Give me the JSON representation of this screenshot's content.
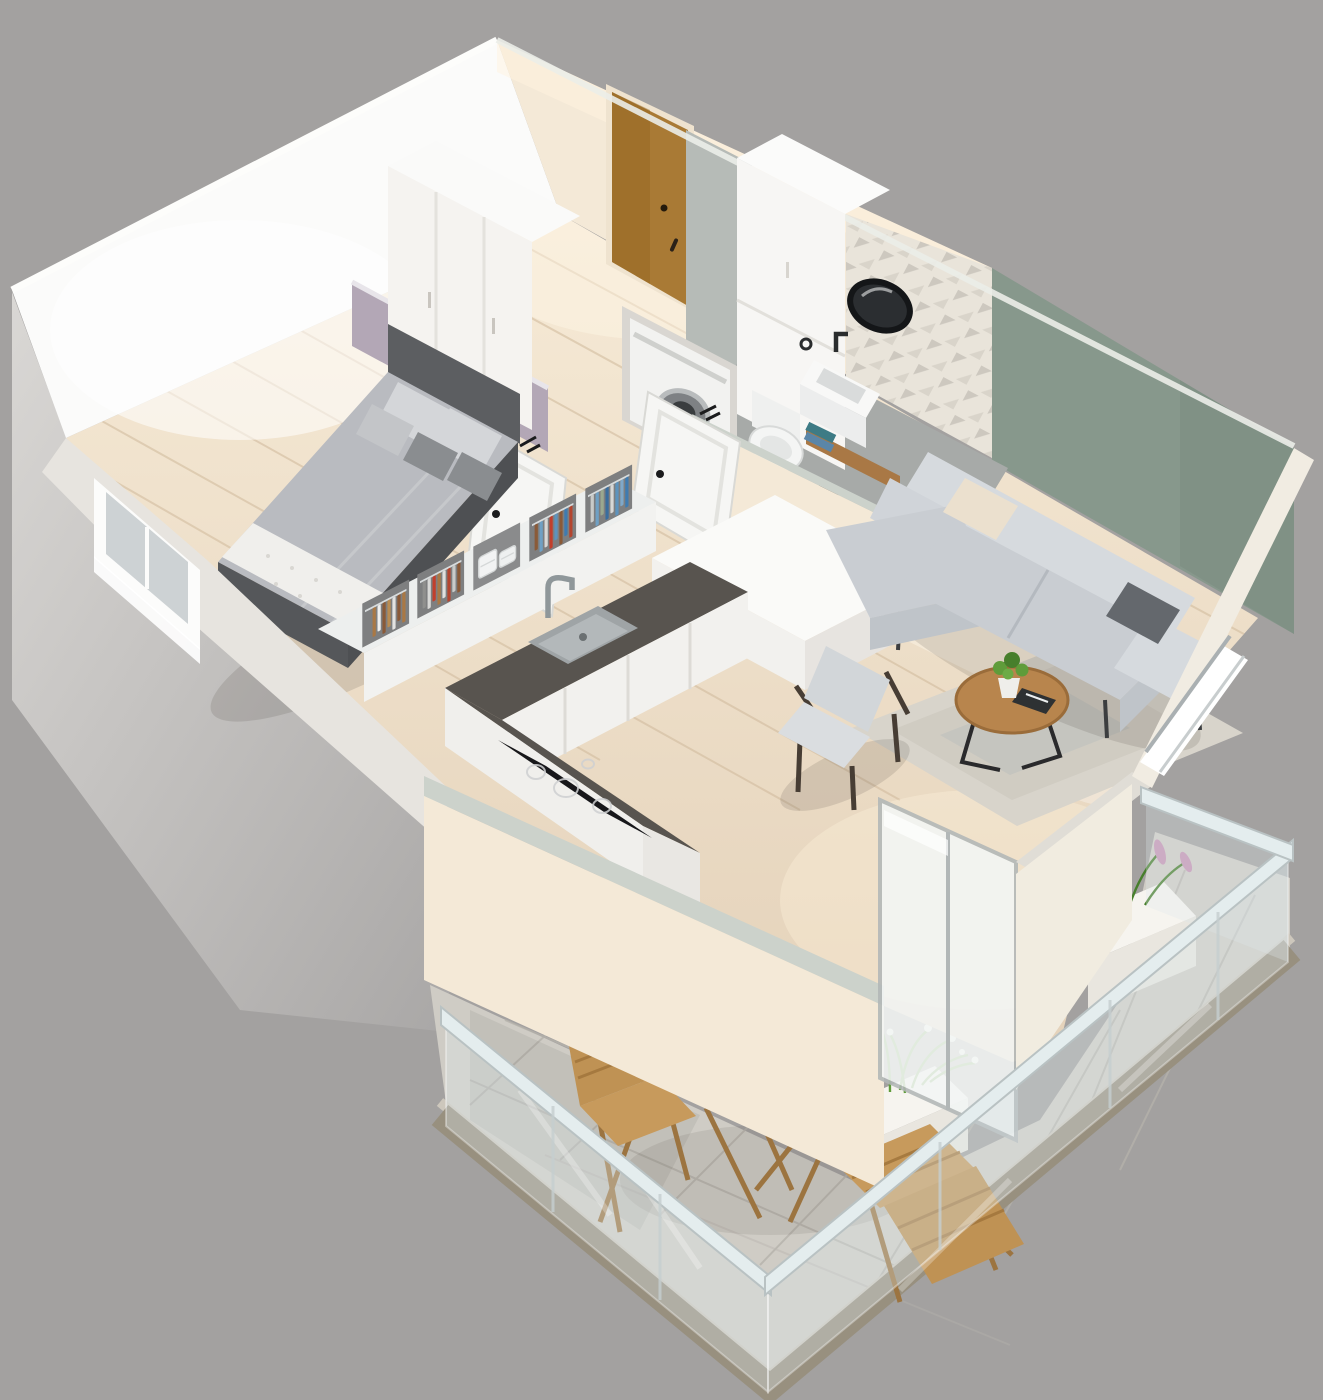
{
  "scene": {
    "title": "Isometric 3D cutaway floor plan of a one-bedroom apartment with balcony",
    "view": "isometric cutaway render, no visible text",
    "width_px": 1323,
    "height_px": 1400
  },
  "palette": {
    "background": "#a3a1a0",
    "wall_bright": "#fbfbfa",
    "wall_cream": "#f4e9d7",
    "wall_top": "#ccd2cb",
    "wall_outer": "#e7e4df",
    "partition_gray": "#b6bbb7",
    "accent_lavender": "#b3a7b6",
    "accent_green": "#87988c",
    "floor_wood": "#e8d8c2",
    "floor_wood_lines": "#d2bc9f",
    "floor_bath": "#a7aaa8",
    "tile_wall": "#e9e4da",
    "tile_triangle": "#c6c1b8",
    "balcony_tile": "#cfccc5",
    "slab_dark": "#98907f",
    "slab_light": "#cdc7bc",
    "door_wood": "#a97a35",
    "door_white": "#f6f6f4",
    "bed_frame": "#5c5e61",
    "bed_duvet": "#b9bbc0",
    "bed_pillow_light": "#d4d6d9",
    "bed_pillow_dark": "#8a8d90",
    "bed_runner": "#f0efec",
    "wardrobe": "#f5f3f0",
    "sofa": "#c9cdd2",
    "sofa_light": "#d6dade",
    "pillow_cream": "#ebe0ce",
    "pillow_dark": "#64686d",
    "counter_top": "#58544f",
    "cabinet_white": "#f2f1ee",
    "cooktop": "#17171a",
    "sink_steel": "#b3b8ba",
    "rug": "#d8d4cb",
    "table_wood": "#b8854d",
    "chair_fabric": "#d2d6d9",
    "frame_dark": "#473d34",
    "glass": "#dde9ea",
    "glass_rail": "#e4edee",
    "plant_green": "#5f9c3a",
    "plant_green_dark": "#477f2c",
    "flower_pink": "#c593b4",
    "flower_white": "#f6f8ef",
    "outdoor_wood": "#bf9254",
    "mirror_dark": "#2b2e31",
    "fixture_white": "#f4f5f4",
    "shelf_wood": "#a97845",
    "towel_teal": "#3e7b85",
    "towel_blue": "#5b86a8",
    "basket_dark": "#1f2022",
    "clothes_colors": [
      "#3f7bb0",
      "#5d93bd",
      "#7fa8c9",
      "#b4452f",
      "#c23f2c",
      "#8a5a38",
      "#a97845",
      "#d8d8d6",
      "#c9cbc9",
      "#6fa0c4"
    ]
  },
  "rooms": [
    {
      "id": "hallway",
      "label": "Entry hall",
      "features": [
        "wooden entrance door",
        "built-in white wardrobe",
        "light wood floor"
      ]
    },
    {
      "id": "bedroom",
      "label": "Bedroom",
      "features": [
        "lavender accent wall",
        "double bed with gray bedding and four pillows",
        "white patterned runner",
        "window in side wall",
        "open closet with hanging clothes"
      ]
    },
    {
      "id": "bathroom",
      "label": "Bathroom",
      "features": [
        "geometric tiled accent wall",
        "round black mirror",
        "wall-hung washbasin with black faucet",
        "wooden shelf with towels",
        "wire laundry basket",
        "wall-hung toilet",
        "tall white cabinet",
        "washing machine",
        "gray floor",
        "white panel door ajar"
      ]
    },
    {
      "id": "kitchen",
      "label": "Kitchen",
      "features": [
        "L-shaped white cabinets",
        "dark worktop",
        "undermount sink with tall faucet",
        "black induction cooktop",
        "tall white cabinet block"
      ]
    },
    {
      "id": "living_room",
      "label": "Living room",
      "features": [
        "sage green accent wall",
        "L-shaped light gray sofa with chaise",
        "cream pillow",
        "graphite pillow",
        "beige rug",
        "round wooden coffee table with plant",
        "mid-century armchair",
        "window with lit sill",
        "sliding glass door to balcony"
      ]
    },
    {
      "id": "balcony",
      "label": "Balcony",
      "features": [
        "frameless glass railing",
        "stone tile floor",
        "folding wooden bistro table with wine bottle and book",
        "two folding wooden chairs",
        "planter with pink flowers",
        "planter with white flowers"
      ]
    }
  ]
}
